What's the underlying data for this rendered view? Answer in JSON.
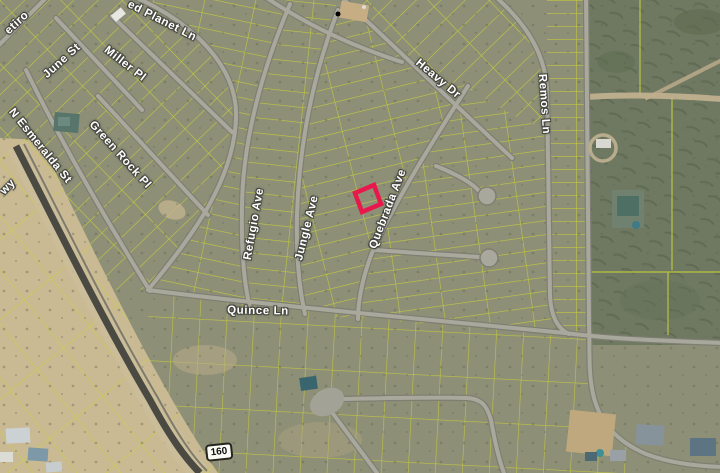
{
  "map": {
    "view": "satellite-parcel-map",
    "street_labels": [
      {
        "id": "retiro",
        "text": "etiro"
      },
      {
        "id": "red-planet-ln",
        "text": "ed Planet Ln"
      },
      {
        "id": "june-st",
        "text": "June St"
      },
      {
        "id": "miller-pl",
        "text": "Miller Pl"
      },
      {
        "id": "n-esmeralda-st",
        "text": "N Esmeralda St"
      },
      {
        "id": "green-rock-pl",
        "text": "Green Rock Pl"
      },
      {
        "id": "hwy",
        "text": "wy"
      },
      {
        "id": "refugio-ave",
        "text": "Refugio Ave"
      },
      {
        "id": "jungle-ave",
        "text": "Jungle Ave"
      },
      {
        "id": "heavy-dr",
        "text": "Heavy Dr"
      },
      {
        "id": "quebrada-ave",
        "text": "Quebrada Ave"
      },
      {
        "id": "remos-ln",
        "text": "Remos Ln"
      },
      {
        "id": "quince-ln",
        "text": "Quince Ln"
      }
    ],
    "route_shield": {
      "number": "160"
    },
    "highlight_parcel": {
      "outline_color": "#e8184d"
    },
    "colors": {
      "parcel_line": "#ccd236",
      "terrain": "#8d8f77",
      "terrain_dark_vegetation": "#6f7961",
      "sand": "#c9ba93",
      "road": "#a8a89d",
      "label_text": "#ffffff"
    }
  }
}
